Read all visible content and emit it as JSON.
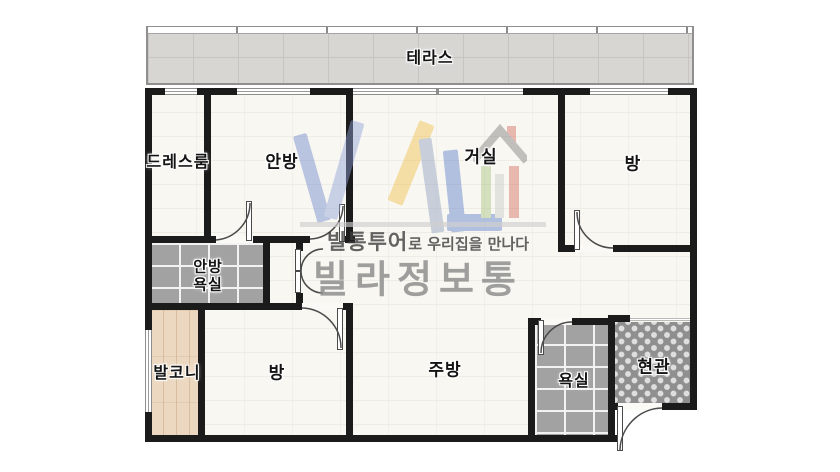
{
  "watermark": {
    "tagline_bold": "빌통투어",
    "tagline_rest": "로 우리집을 만나다",
    "brand": "빌라정보통"
  },
  "rooms": {
    "terrace": "테라스",
    "dressroom": "드레스룸",
    "master_bedroom": "안방",
    "living_room": "거실",
    "bedroom_right": "방",
    "master_bath_line1": "안방",
    "master_bath_line2": "욕실",
    "balcony": "발코니",
    "bedroom_bottom": "방",
    "kitchen": "주방",
    "bathroom": "욕실",
    "entrance": "현관"
  },
  "colors": {
    "wall": "#1b1b1b",
    "floor": "#f8f7f2",
    "terrace_tile": "#d7d6d3",
    "dark_tile": "#a2a2a2",
    "entry_tile": "#8f8f8f",
    "wood": "#ecd8c0",
    "logo_blue": "#6d87cb",
    "logo_light_blue": "#8fa3d8",
    "logo_yellow": "#f2c14b",
    "logo_green": "#a8c47e",
    "logo_red": "#d66a5e"
  }
}
